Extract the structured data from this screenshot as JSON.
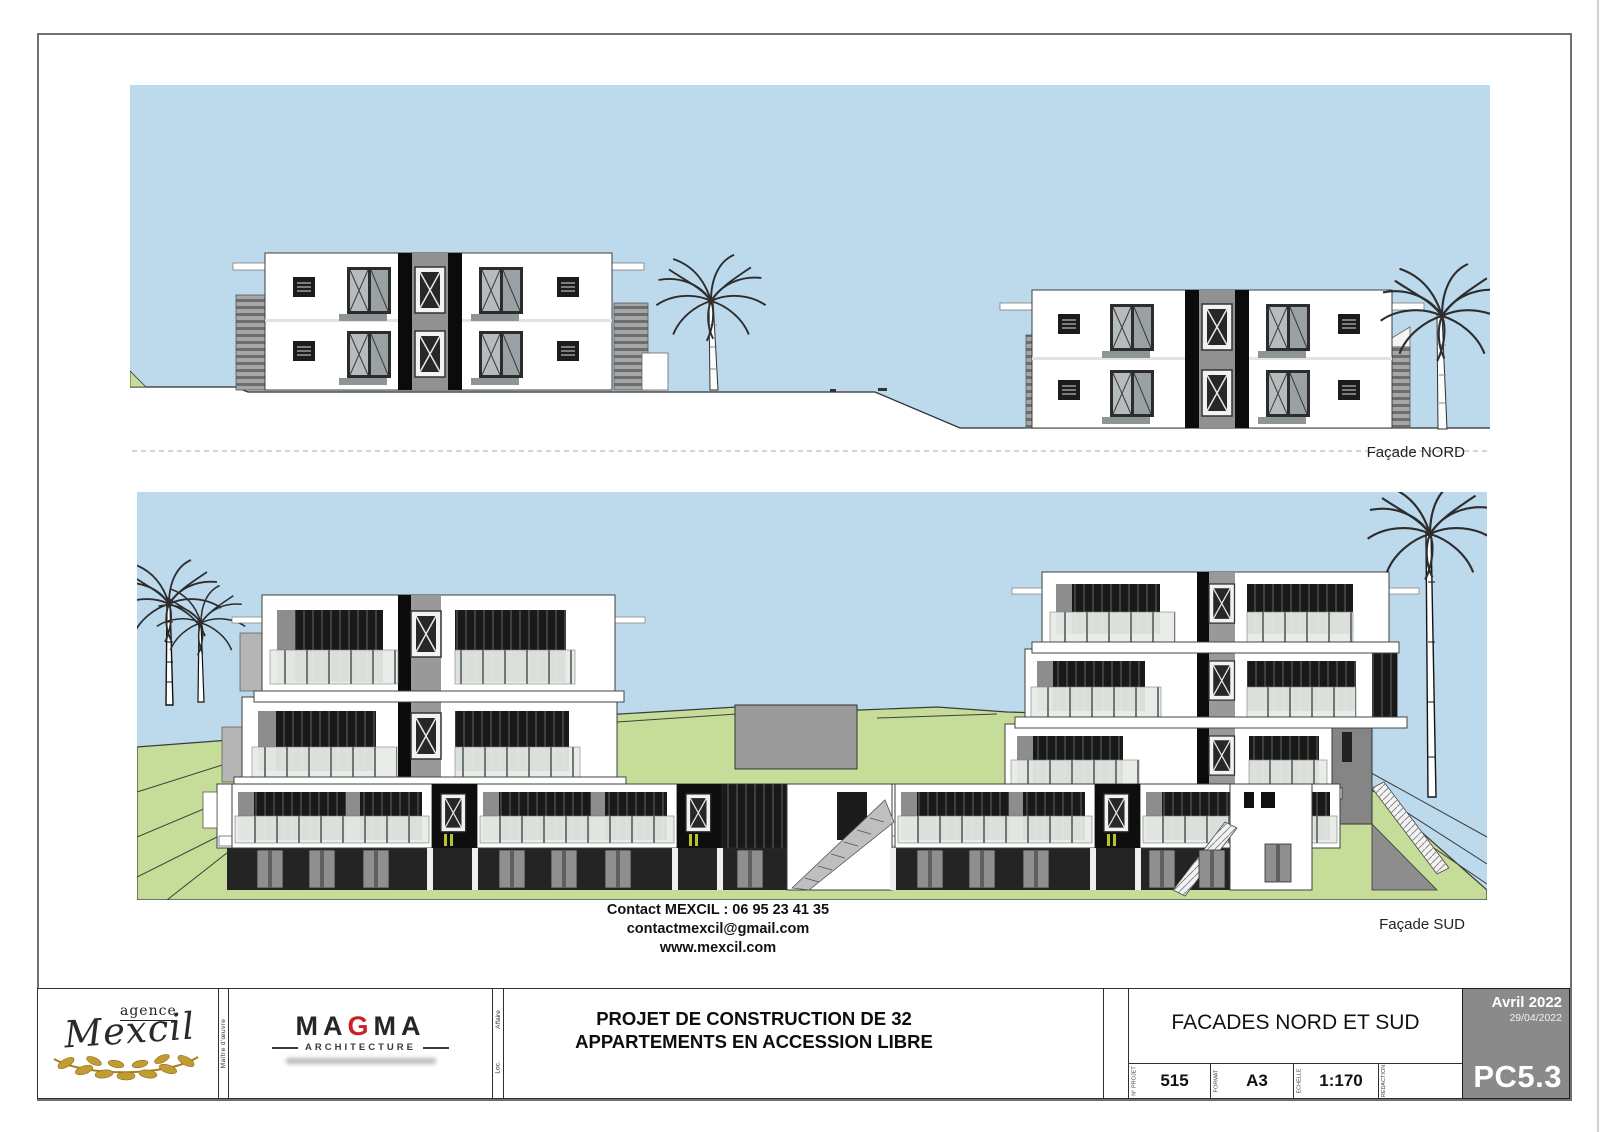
{
  "sheet": {
    "facade_nord_label": "Façade NORD",
    "facade_sud_label": "Façade SUD"
  },
  "contact": {
    "line1": "Contact MEXCIL : 06 95 23 41 35",
    "line2": "contactmexcil@gmail.com",
    "line3": "www.mexcil.com"
  },
  "title_block": {
    "agency": {
      "word_agence": "agence",
      "word_mexcil": "Mexcil"
    },
    "magma": {
      "part1": "MA",
      "part2": "G",
      "part3": "MA",
      "subtitle": "ARCHITECTURE"
    },
    "labels": {
      "maitre_oeuvre": "Maître d'œuvre",
      "affaire": "Affaire",
      "loc": "Loc."
    },
    "project_title": {
      "line1": "PROJET DE CONSTRUCTION DE 32",
      "line2": "APPARTEMENTS EN ACCESSION LIBRE"
    },
    "sheet_title": "FACADES NORD ET SUD",
    "fields": [
      {
        "label": "N° PROJET",
        "value": "515"
      },
      {
        "label": "FORMAT",
        "value": "A3"
      },
      {
        "label": "ECHELLE",
        "value": "1:170"
      },
      {
        "label": "REDACTION",
        "value": ""
      }
    ],
    "stamp": {
      "month": "Avril 2022",
      "date": "29/04/2022",
      "code": "PC5.3"
    }
  },
  "colors": {
    "sky": "#bcdaec",
    "grass": "#c5dd99",
    "stamp_gray": "#8a8a8a",
    "magma_red": "#cb2026",
    "laurel_gold": "#c29b32",
    "accent_yellow": "#b9c427"
  }
}
